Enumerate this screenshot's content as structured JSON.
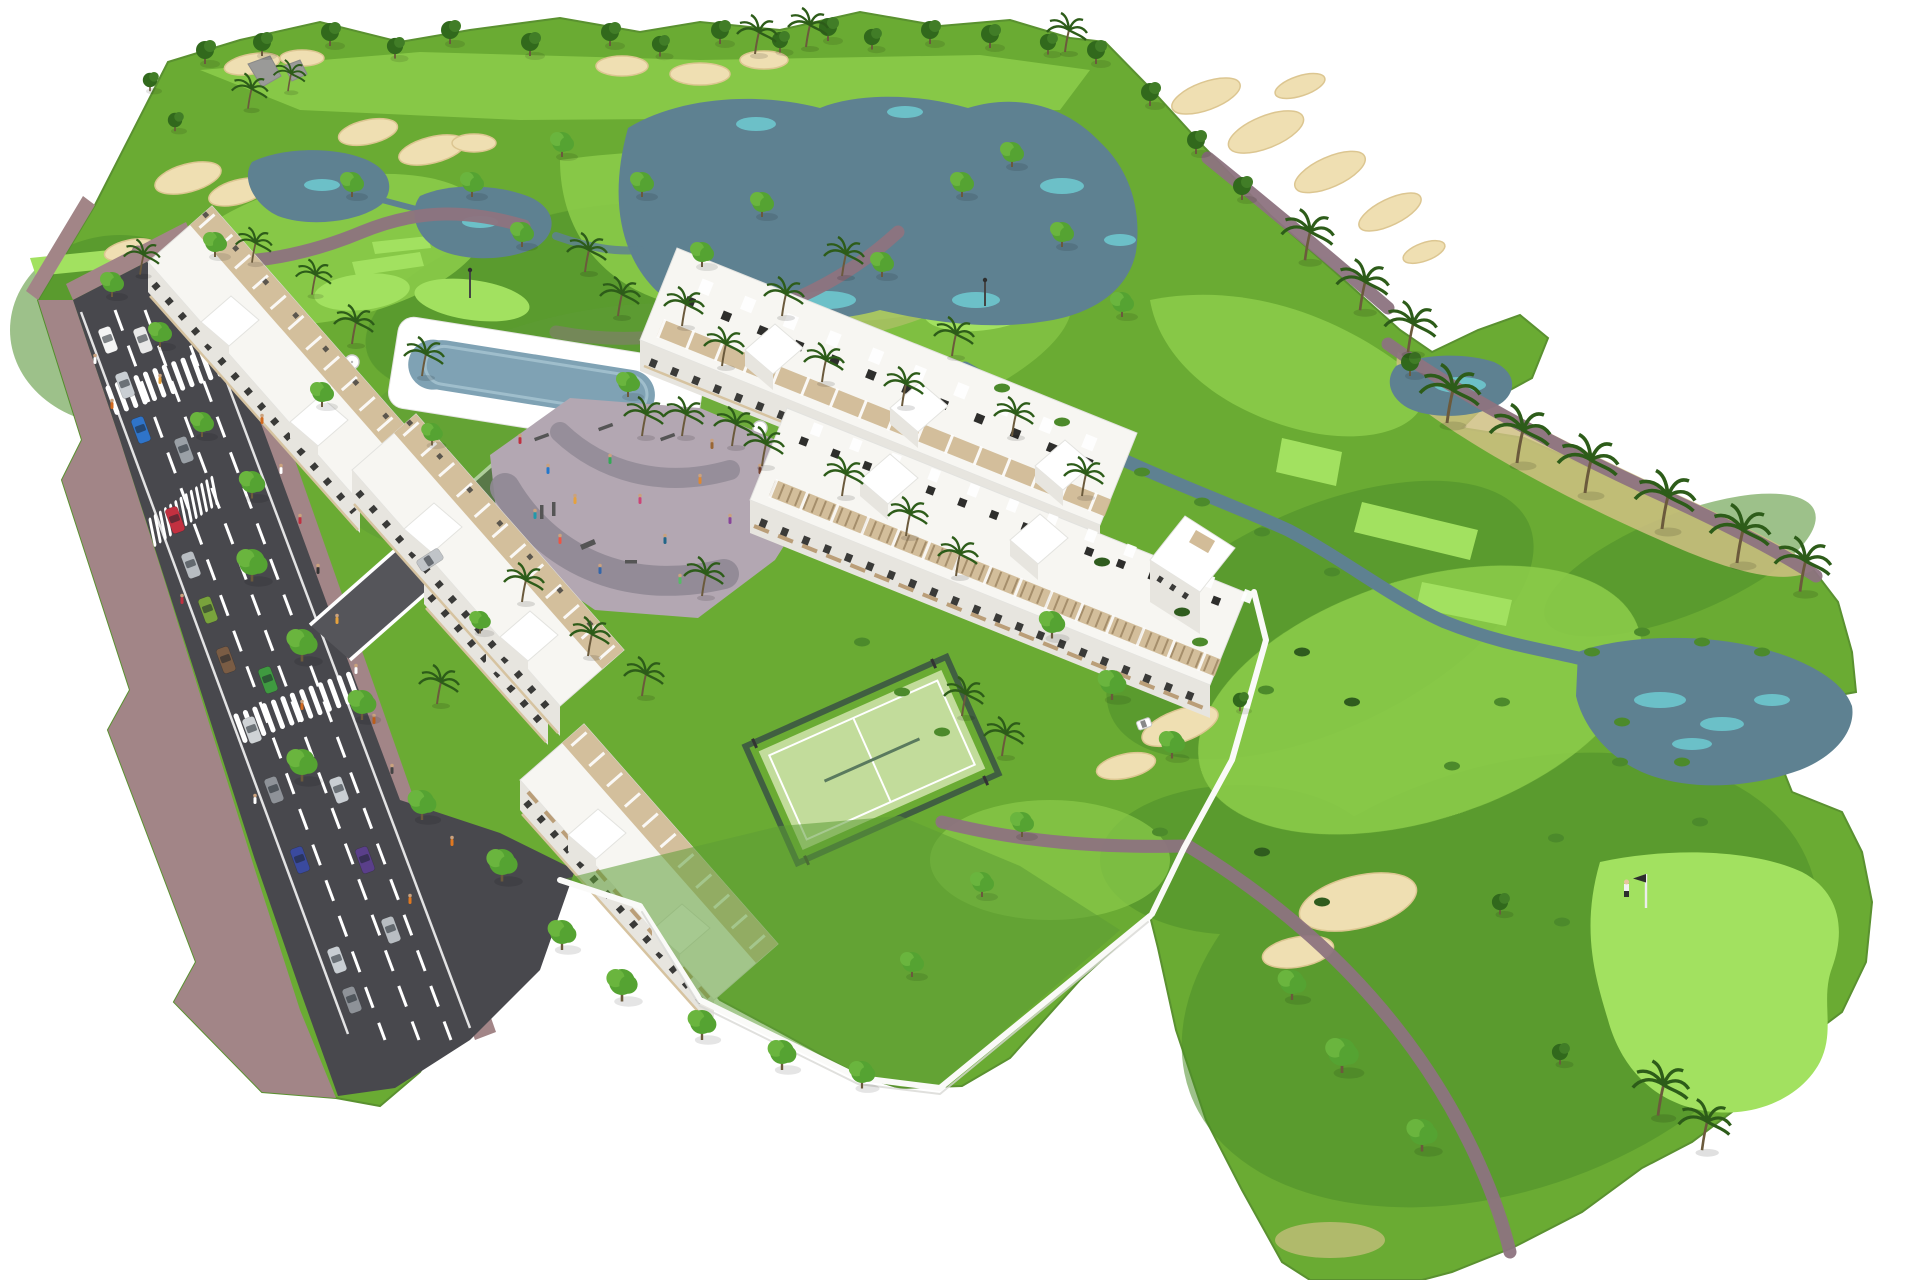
{
  "title": "Aerial 3D architectural rendering of a golf-resort apartment development beside a golf course",
  "scene": {
    "setting": "computer-generated bird's-eye render on a plain white background",
    "features": [
      "golf course with fairways, light tee boxes, putting greens, lakes, streams and sand bunkers",
      "avenue with dashed lane markings, zebra crossings, brick sidewalks, parked and moving cars",
      "white low-rise apartment blocks with rooftop terraces, stair towers and balconies",
      "communal swimming pool with white deck, sun umbrellas and loungers",
      "children's playground on grey paving with play equipment and people",
      "fenced padel tennis court with light-green surface",
      "golf green with white flagstick and a golfer",
      "white golf cart on a cart path",
      "white perimeter garden walls, round trees and palm trees"
    ],
    "counts": {
      "apartment_rows": 5,
      "stair_towers": 10,
      "lakes_and_ponds": 5,
      "sand_bunkers": 22,
      "zebra_crossings": 3,
      "parked_cars": 12,
      "moving_cars": 6,
      "golf_flags": 3
    }
  },
  "palette": {
    "bg": "#ffffff",
    "grassMid": "#6aab33",
    "grassDark": "#4e8f2a",
    "grassLight": "#8bcb4a",
    "grassTee": "#a2e160",
    "grassGarden": "#5d9c35",
    "sand": "#efdfb2",
    "sandEdge": "#dcc691",
    "sandDry": "#cfc083",
    "lake": "#5e8191",
    "lakeLight": "#6fd0d6",
    "pathC": "#8d7380",
    "paving": "#b3a7b2",
    "pavingDark": "#8f8894",
    "padel": "#c2dc9b",
    "fence": "#3c5743",
    "asphalt": "#48484d",
    "asphalt2": "#55555a",
    "walk": "#a28587",
    "bldRoof": "#f7f6f2",
    "bldFacade": "#e7e5df",
    "slab": "#d6c3a0",
    "terrace": "#cdb58d",
    "wood": "#b08d5f",
    "dark": "#3a3a38",
    "poolWater": "#7fa2b4",
    "poolLight": "#a8c6d2",
    "treeDark": "#31691c",
    "treeDark2": "#417d27",
    "treeBright": "#55a332",
    "treeBright2": "#6ab53e",
    "palmFrond": "#2d5c19",
    "trunk": "#6b5a3c",
    "bush": "#4c8a2b",
    "bushDark": "#2f5c1e"
  }
}
